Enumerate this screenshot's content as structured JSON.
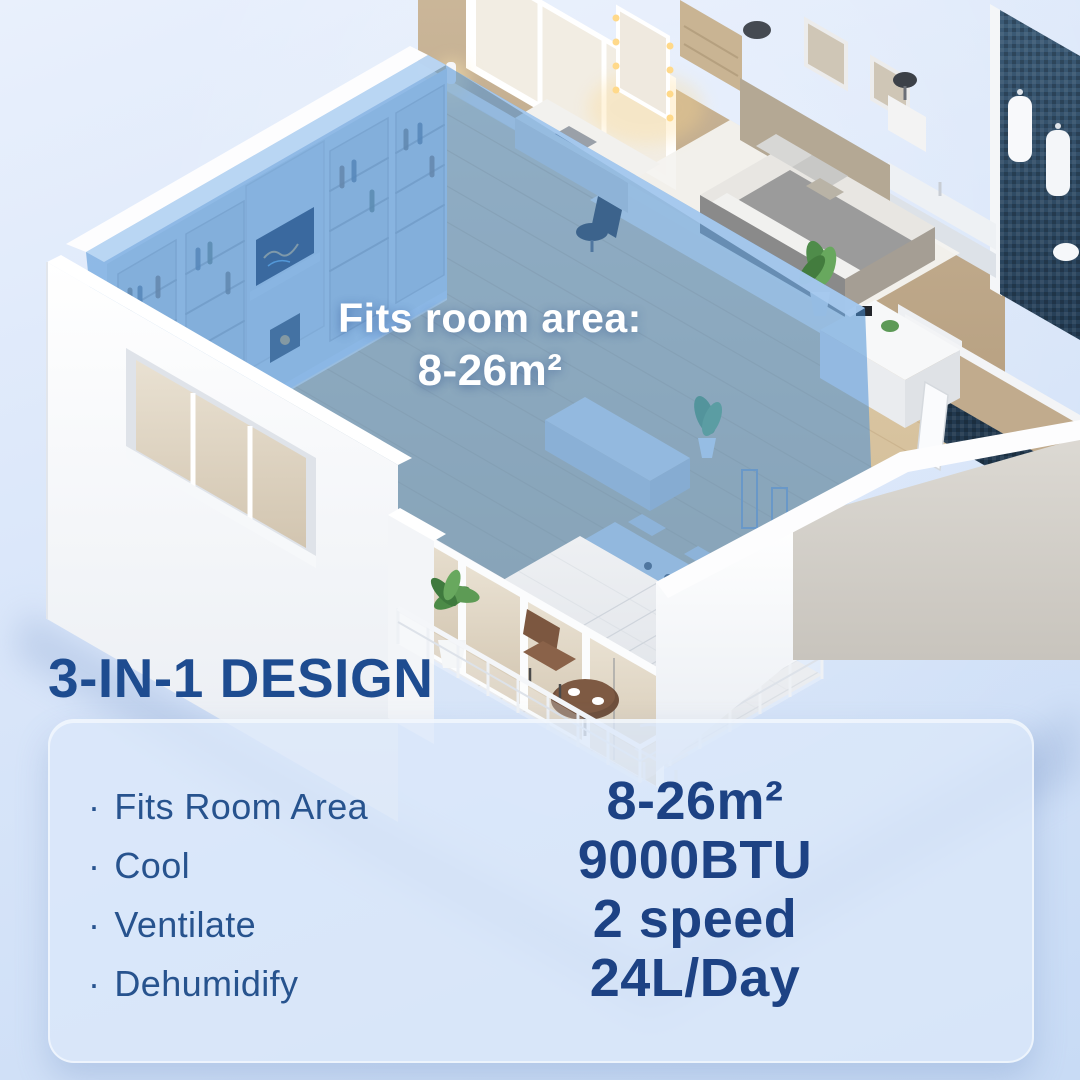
{
  "hero": {
    "caption": {
      "line1": "Fits room area:",
      "line2": "8-26m²"
    }
  },
  "features_section": {
    "heading": "3-IN-1 DESIGN",
    "bullet_char": "·",
    "features": [
      {
        "label": "Fits Room Area",
        "value": "8-26m²"
      },
      {
        "label": "Cool",
        "value": "9000BTU"
      },
      {
        "label": "Ventilate",
        "value": "2 speed"
      },
      {
        "label": "Dehumidify",
        "value": "24L/Day"
      }
    ]
  },
  "colors": {
    "heading_text": "#1e4c90",
    "label_text": "#27538e",
    "value_text": "#1d4284",
    "caption_text": "#ffffff",
    "room_highlight": "#4b8fd6",
    "background_top": "#e9f0fc",
    "background_bottom": "#c8dbf5",
    "card_background": "rgba(219,232,250,0.78)"
  }
}
